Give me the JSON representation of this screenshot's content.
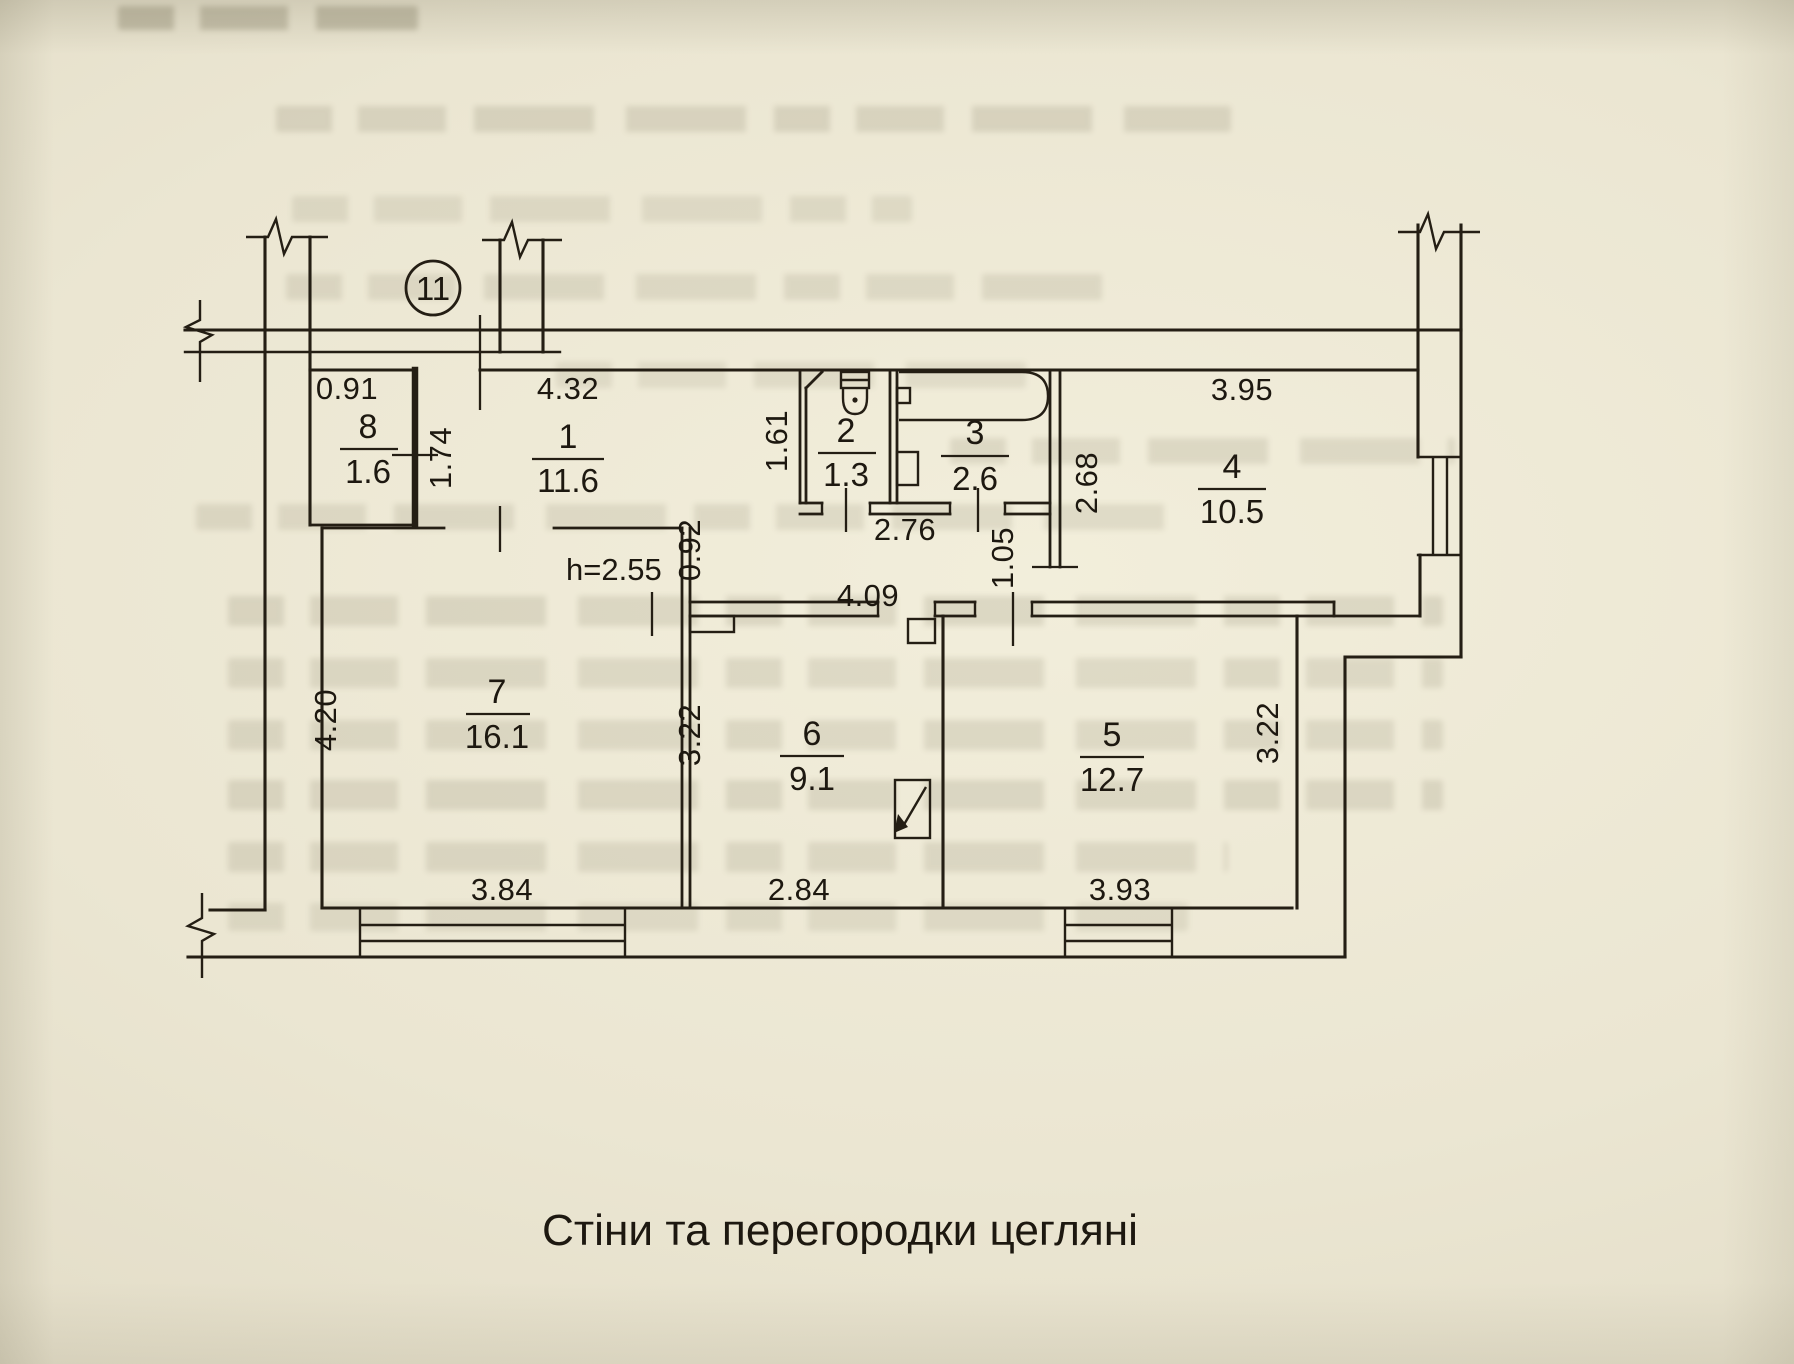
{
  "colors": {
    "paper": "#ebe6d2",
    "ink": "#241e14"
  },
  "plan": {
    "apartment_number": "11",
    "ceiling_height_note": "h=2.55",
    "rooms": [
      {
        "number": "1",
        "area": "11.6"
      },
      {
        "number": "2",
        "area": "1.3"
      },
      {
        "number": "3",
        "area": "2.6"
      },
      {
        "number": "4",
        "area": "10.5"
      },
      {
        "number": "5",
        "area": "12.7"
      },
      {
        "number": "6",
        "area": "9.1"
      },
      {
        "number": "7",
        "area": "16.1"
      },
      {
        "number": "8",
        "area": "1.6"
      }
    ],
    "dims": {
      "closet_width_top": "0.91",
      "hall_top": "4.32",
      "closet_side": "1.74",
      "wc_side": "1.61",
      "bath_bottom": "2.76",
      "room4_side": "2.68",
      "room4_door": "1.05",
      "hall_step": "0.92",
      "hall_bottom": "4.09",
      "room4_top": "3.95",
      "room7_side": "4.20",
      "room6_side": "3.22",
      "room5_side": "3.22",
      "room7_bottom": "3.84",
      "room6_bottom": "2.84",
      "room5_bottom": "3.93"
    }
  },
  "caption": "Стіни та перегородки цегляні"
}
